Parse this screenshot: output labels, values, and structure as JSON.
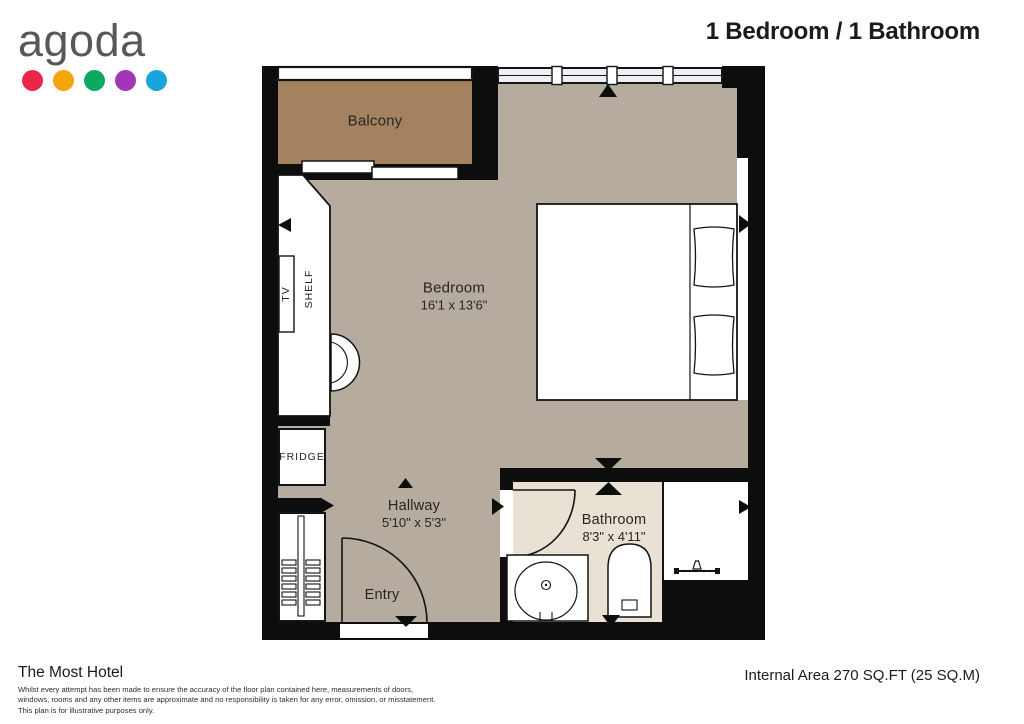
{
  "header": {
    "logo_text": "agoda",
    "logo_dots": [
      "#e8274b",
      "#f3a50b",
      "#0ca95f",
      "#a434b8",
      "#16a5dc"
    ],
    "title": "1 Bedroom / 1 Bathroom"
  },
  "plan": {
    "colors": {
      "wall": "#0d0d0d",
      "bedroom_floor": "#b5ab9e",
      "balcony_floor": "#a5825f",
      "bathroom_floor": "#e9e1d4",
      "window_fill": "#edeff5"
    },
    "rooms": {
      "balcony": {
        "label": "Balcony"
      },
      "bedroom": {
        "label": "Bedroom",
        "dimensions": "16'1 x 13'6\""
      },
      "hallway": {
        "label": "Hallway",
        "dimensions": "5'10\" x 5'3\""
      },
      "bathroom": {
        "label": "Bathroom",
        "dimensions": "8'3\" x 4'11\""
      },
      "entry": {
        "label": "Entry"
      }
    },
    "fixtures": {
      "tv": "TV",
      "shelf": "SHELF",
      "fridge": "FRIDGE"
    }
  },
  "footer": {
    "hotel_name": "The Most Hotel",
    "disclaimer_lines": [
      "Whilst every attempt has been made to ensure the accuracy of the floor plan contained here, measurements of doors,",
      "windows, rooms and any other items are approximate and no responsibility is taken for any error, omission, or misstatement.",
      "This plan is for illustrative purposes only."
    ],
    "area_text": "Internal Area 270 SQ.FT (25 SQ.M)"
  }
}
